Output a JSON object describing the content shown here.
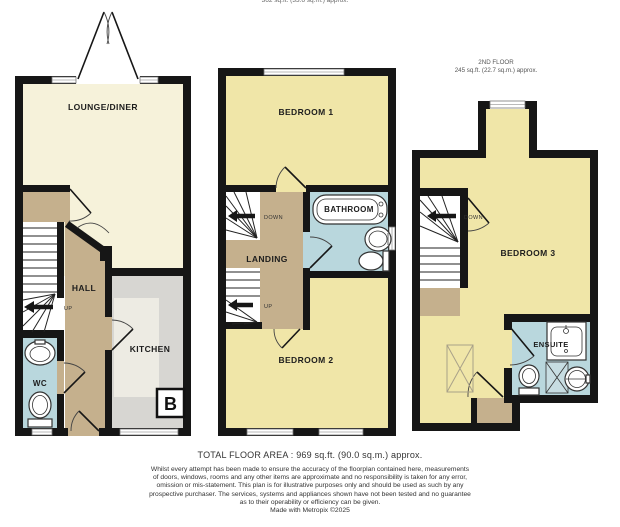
{
  "page": {
    "clipped_top_label": "362 sq.ft. (33.6 sq.m.) approx."
  },
  "ground_floor": {
    "lounge_label": "LOUNGE/DINER",
    "hall_label": "HALL",
    "kitchen_label": "KITCHEN",
    "wc_label": "WC",
    "stair_up_label": "UP",
    "boiler_label": "B"
  },
  "first_floor": {
    "bedroom1_label": "BEDROOM 1",
    "landing_label": "LANDING",
    "bathroom_label": "BATHROOM",
    "bedroom2_label": "BEDROOM 2",
    "stair_down_label": "DOWN",
    "stair_up_label": "UP"
  },
  "second_floor": {
    "floor_label": "2ND FLOOR",
    "area_label": "245 sq.ft. (22.7 sq.m.) approx.",
    "bedroom3_label": "BEDROOM 3",
    "ensuite_label": "ENSUITE",
    "stair_down_label": "DOWN"
  },
  "footer": {
    "total_area": "TOTAL FLOOR AREA : 969 sq.ft. (90.0 sq.m.) approx.",
    "disclaimer_lines": [
      "Whilst every attempt has been made to ensure the accuracy of the floorplan contained here, measurements",
      "of doors, windows, rooms and any other items are approximate and no responsibility is taken for any error,",
      "omission or mis-statement. This plan is for illustrative purposes only and should be used as such by any",
      "prospective purchaser. The services, systems and appliances shown have not been tested and no guarantee",
      "as to their operability or efficiency can be given.",
      "Made with Metropix ©2025"
    ]
  },
  "colors": {
    "wall": "#161616",
    "lounge": "#f6f2da",
    "bedroom": "#f0e6a8",
    "hall": "#c5b08d",
    "kitchen_counter": "#d7d6d2",
    "kitchen_floor": "#edebe3",
    "bathroom": "#b9d7dd",
    "stairs": "#ffffff"
  }
}
